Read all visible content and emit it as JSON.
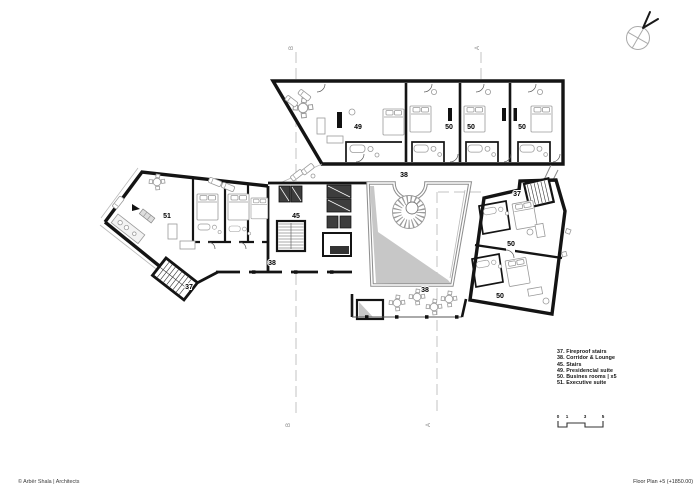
{
  "page": {
    "width": 700,
    "height": 495,
    "background": "#ffffff"
  },
  "plan": {
    "room_labels": [
      {
        "text": "49",
        "x": 358,
        "y": 129
      },
      {
        "text": "50",
        "x": 449,
        "y": 129
      },
      {
        "text": "50",
        "x": 471,
        "y": 129
      },
      {
        "text": "50",
        "x": 522,
        "y": 129
      },
      {
        "text": "38",
        "x": 404,
        "y": 177
      },
      {
        "text": "37",
        "x": 517,
        "y": 196
      },
      {
        "text": "45",
        "x": 296,
        "y": 218
      },
      {
        "text": "51",
        "x": 167,
        "y": 218
      },
      {
        "text": "50",
        "x": 511,
        "y": 246
      },
      {
        "text": "38",
        "x": 272,
        "y": 265
      },
      {
        "text": "37",
        "x": 189,
        "y": 289
      },
      {
        "text": "38",
        "x": 425,
        "y": 292
      },
      {
        "text": "50",
        "x": 500,
        "y": 298
      }
    ],
    "section_markers": [
      {
        "label": "B",
        "x": 293,
        "y": 48
      },
      {
        "label": "A",
        "x": 479,
        "y": 48
      },
      {
        "label": "B",
        "x": 290,
        "y": 425
      },
      {
        "label": "A",
        "x": 430,
        "y": 425
      }
    ],
    "colors": {
      "wall": "#141414",
      "atrium_wall": "#8f8f8f",
      "shadow": "#c7c7c7",
      "furniture": "#9a9a9a",
      "section_line": "#c3c3c3"
    },
    "icons": {
      "compass": "north-arrow-compass"
    }
  },
  "legend": {
    "items": [
      "37. Fireproof stairs",
      "38. Corridor & Lounge",
      "45. Stairs",
      "49. Presidencial suite",
      "50. Busines rooms | x5",
      "51. Executive suite"
    ]
  },
  "scale_bar": {
    "labels": [
      {
        "text": "0",
        "x": 558
      },
      {
        "text": "1",
        "x": 567
      },
      {
        "text": "3",
        "x": 585
      },
      {
        "text": "5",
        "x": 603
      }
    ]
  },
  "footer": {
    "copyright": "© Arbër Shala | Architects",
    "drawing_title": "Floor Plan +5 (+1850.00)"
  }
}
